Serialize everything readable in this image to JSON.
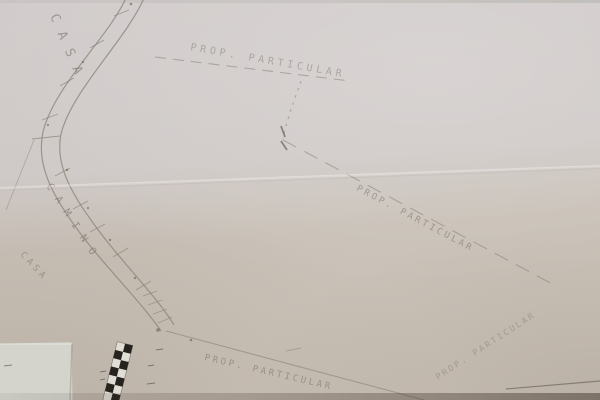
{
  "map": {
    "labels": {
      "casa_top": "CASA",
      "camino": "CAMINO",
      "casa_left": "CASA",
      "prop_top": "PROP. PARTICULAR",
      "prop_middle": "PROP. PARTICULAR",
      "prop_bottom": "PROP. PARTICULAR",
      "prop_right_edge": "PROP. PARTICULAR"
    },
    "colors": {
      "paper": "#cfc9c6",
      "paper_lower": "#c9c0b6",
      "paper_patch": "#d6d7d0",
      "ink_faint": "#8a8177",
      "ink_dark": "#57504a",
      "scale_bar_black": "#17130f"
    }
  }
}
